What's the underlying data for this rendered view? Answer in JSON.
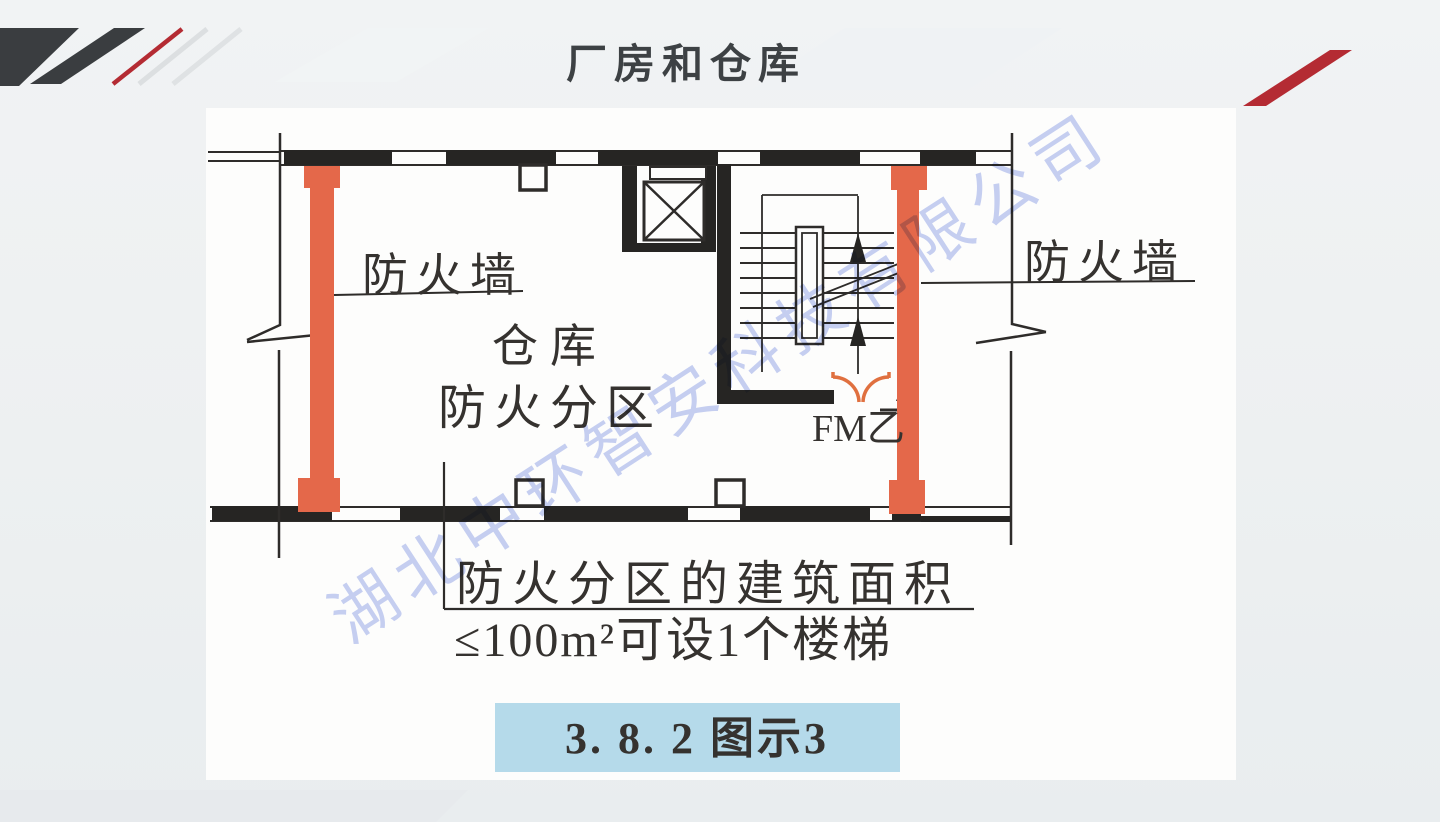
{
  "slide": {
    "title": "厂房和仓库",
    "watermark": "湖北中环智安科技有限公司"
  },
  "plan": {
    "firewall_label_left": "防火墙",
    "firewall_label_right": "防火墙",
    "zone_label_line1": "仓库",
    "zone_label_line2": "防火分区",
    "door_label": "FM乙",
    "caption_line1": "防火分区的建筑面积",
    "caption_line2": "≤100m²可设1个楼梯",
    "figure_caption": "3. 8. 2  图示3"
  },
  "colors": {
    "firewall_fill": "#e4684a",
    "door_arc": "#e0703f",
    "figure_caption_bg": "#b5daea",
    "accent_red": "#b42b33",
    "stripe_dark": "#3a3d40",
    "drawing_line": "#2e2c2a",
    "watermark": "#8fa2e8"
  }
}
